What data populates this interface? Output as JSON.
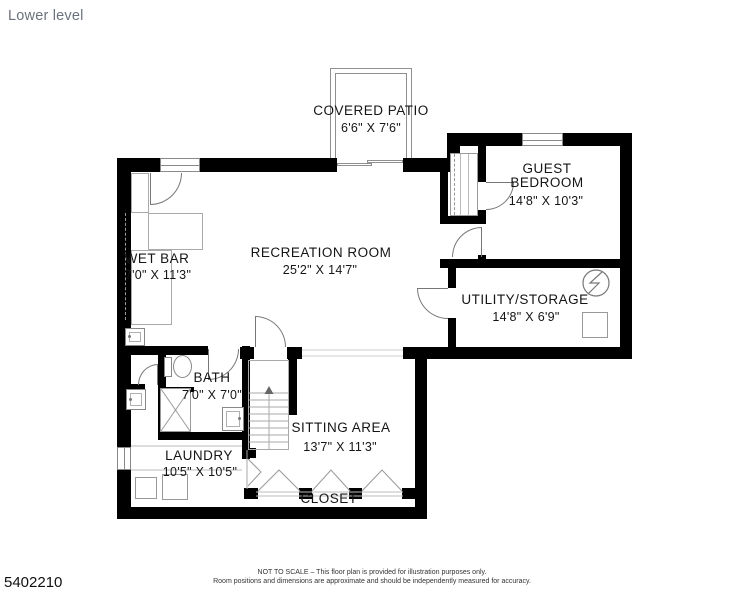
{
  "title": "Lower level",
  "plan": {
    "rooms": {
      "covered_patio": {
        "name": "COVERED PATIO",
        "dims": "6'6\" X 7'6\""
      },
      "guest_bedroom": {
        "line1": "GUEST",
        "line2": "BEDROOM",
        "dims": "14'8\" X 10'3\""
      },
      "recreation_room": {
        "name": "RECREATION ROOM",
        "dims": "25'2\" X 14'7\""
      },
      "wet_bar": {
        "name": "WET BAR",
        "dims": "7'0\" X 11'3\""
      },
      "utility_storage": {
        "name": "UTILITY/STORAGE",
        "dims": "14'8\" X 6'9\""
      },
      "bath": {
        "name": "BATH",
        "dims": "7'0\" X 7'0\""
      },
      "sitting_area": {
        "name": "SITTING AREA",
        "dims": "13'7\" X 11'3\""
      },
      "laundry": {
        "name": "LAUNDRY",
        "dims": "10'5\" X 10'5\""
      },
      "closet": {
        "name": "CLOSET"
      }
    },
    "fixtures": [
      "stairs-up",
      "toilet",
      "shower",
      "bath-sink",
      "hall-sink",
      "wet-bar-counter",
      "wet-bar-sink",
      "washer",
      "dryer",
      "electrical-panel",
      "water-heater",
      "bedroom-closet-shelves",
      "bifold-doors",
      "sliding-patio-door",
      "windows",
      "door-swings"
    ]
  },
  "footer": {
    "listing_id": "5402210",
    "disclaimer_line1": "NOT TO SCALE – This floor plan is provided for illustration purposes only.",
    "disclaimer_line2": "Room positions and dimensions are approximate and should be independently measured for accuracy."
  },
  "colors": {
    "wall": "#000000",
    "fixture_line": "#999999",
    "label_text": "#151515",
    "title_text": "#6c727c",
    "background": "#ffffff"
  }
}
